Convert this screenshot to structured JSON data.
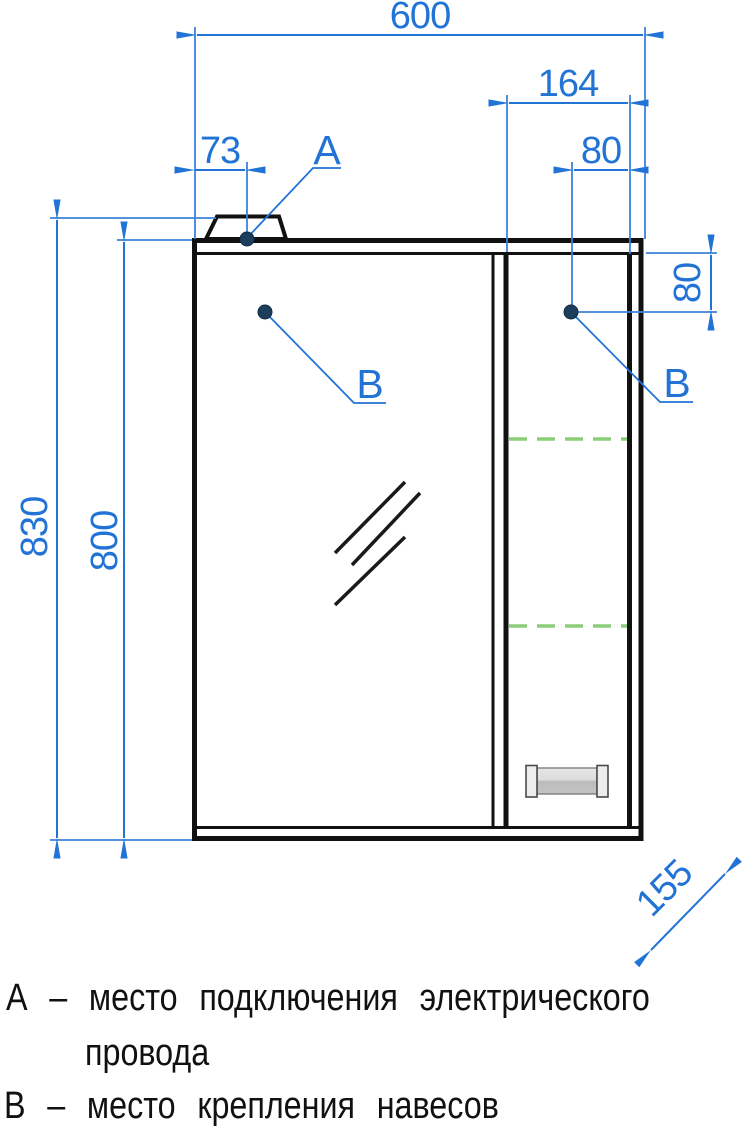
{
  "drawing": {
    "type": "furniture-technical-drawing",
    "dimensions": {
      "total_width": "600",
      "right_section_width": "164",
      "point_a_offset_left": "73",
      "point_b_offset_right": "80",
      "point_b_offset_down": "80",
      "total_height": "830",
      "body_height": "800",
      "depth": "155"
    },
    "callouts": {
      "a_label": "А",
      "b_left_label": "В",
      "b_right_label": "В"
    },
    "legend": {
      "line_a_1": "А – место подключения электрического",
      "line_a_2": "провода",
      "line_b": "В – место крепления навесов"
    },
    "colors": {
      "dimension_blue": "#2273d6",
      "shelf_green": "#8ccd7a",
      "outline_black": "#111111",
      "fastener_dot": "#1d3d5d",
      "handle_gray_light": "#e6e6e6",
      "handle_gray_dark": "#bdbdbd"
    }
  }
}
